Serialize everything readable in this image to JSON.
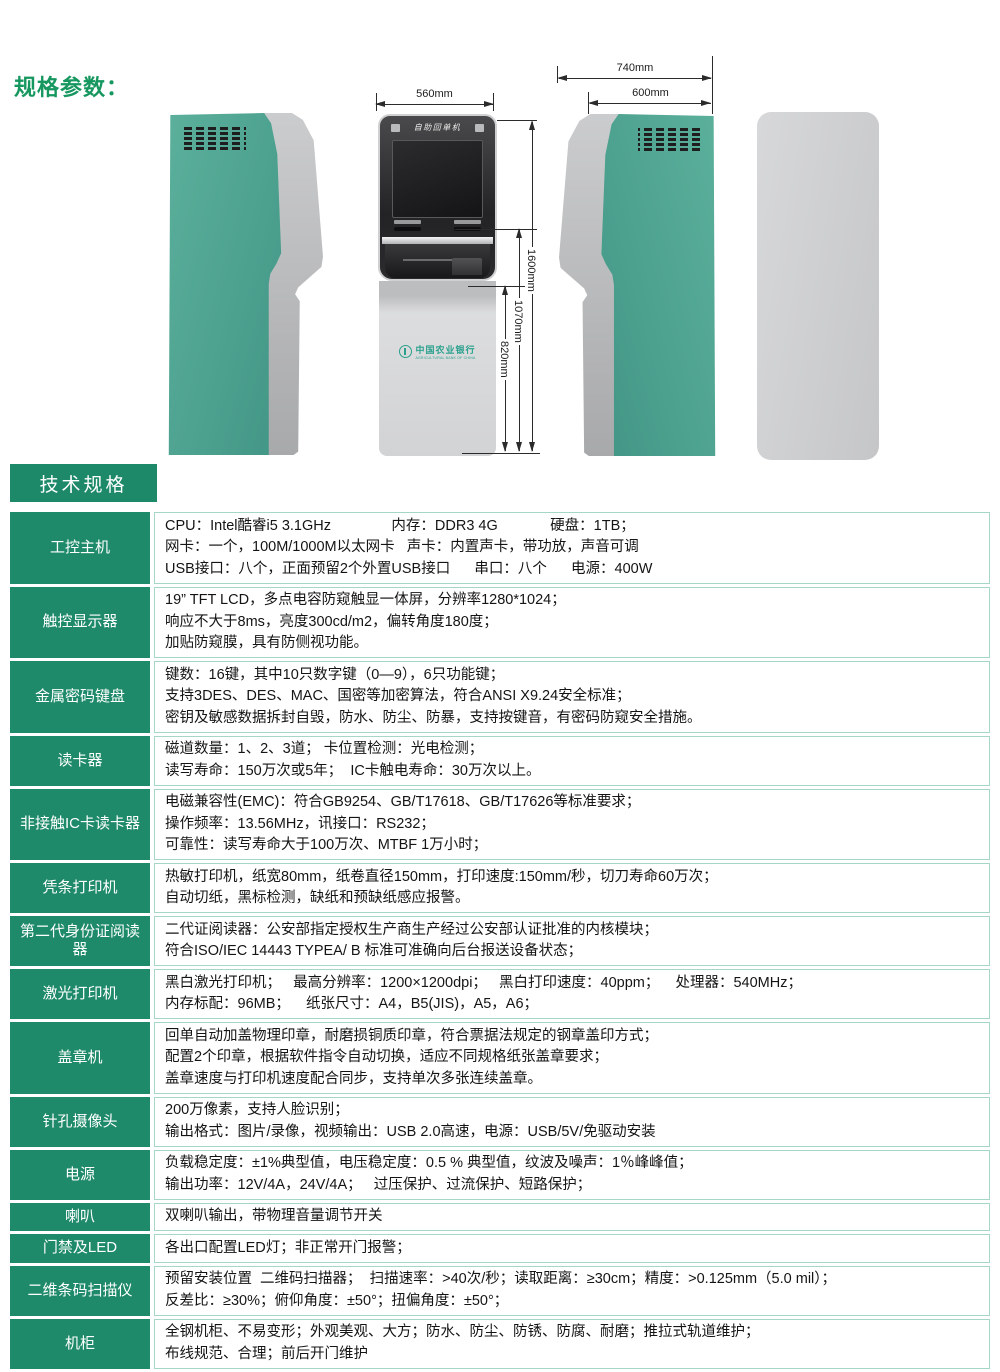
{
  "heading": "规格参数：",
  "section_title": "技术规格",
  "colors": {
    "accent_green": "#1e8a69",
    "heading_green": "#16975f",
    "kiosk_green": "#4aa492",
    "table_border": "#a5d6c6",
    "logo_teal": "#2aa18d"
  },
  "figure": {
    "kiosk_title": "自助回单机",
    "bank_cn": "中国农业银行",
    "bank_en": "AGRICULTURAL BANK OF CHINA",
    "dims": {
      "front_width": "560mm",
      "side_depth_total": "740mm",
      "side_depth_body": "600mm",
      "height_total": "1600mm",
      "height_console": "1070mm",
      "height_cabinet": "820mm"
    }
  },
  "table": {
    "rows": [
      {
        "label": "工控主机",
        "lines": [
          "CPU：Intel酷睿i5 3.1GHz               内存：DDR3 4G             硬盘：1TB；",
          "网卡：一个，100M/1000M以太网卡   声卡：内置声卡，带功放，声音可调",
          "USB接口：八个，正面预留2个外置USB接口      串口：八个      电源：400W"
        ]
      },
      {
        "label": "触控显示器",
        "lines": [
          "19” TFT LCD，多点电容防窥触显一体屏，分辨率1280*1024；",
          "响应不大于8ms，亮度300cd/m2，偏转角度180度；",
          "加贴防窥膜，具有防侧视功能。"
        ]
      },
      {
        "label": "金属密码键盘",
        "lines": [
          "键数：16键，其中10只数字键（0—9），6只功能键；",
          "支持3DES、DES、MAC、国密等加密算法，符合ANSI X9.24安全标准；",
          "密钥及敏感数据拆封自毁，防水、防尘、防暴，支持按键音，有密码防窥安全措施。"
        ]
      },
      {
        "label": "读卡器",
        "lines": [
          "磁道数量：1、2、3道； 卡位置检测：光电检测；",
          "读写寿命：150万次或5年；  IC卡触电寿命：30万次以上。"
        ]
      },
      {
        "label": "非接触IC卡读卡器",
        "lines": [
          "电磁兼容性(EMC)：符合GB9254、GB/T17618、GB/T17626等标准要求；",
          "操作频率：13.56MHz，讯接口：RS232；",
          "可靠性：读写寿命大于100万次、MTBF 1万小时；"
        ]
      },
      {
        "label": "凭条打印机",
        "lines": [
          "热敏打印机，纸宽80mm，纸卷直径150mm，打印速度:150mm/秒，切刀寿命60万次；",
          "自动切纸，黑标检测，缺纸和预缺纸感应报警。"
        ]
      },
      {
        "label": "第二代身份证阅读器",
        "lines": [
          "二代证阅读器：公安部指定授权生产商生产经过公安部认证批准的内核模块；",
          "符合ISO/IEC 14443 TYPEA/ B 标准可准确向后台报送设备状态；"
        ]
      },
      {
        "label": "激光打印机",
        "lines": [
          "黑白激光打印机；   最高分辨率：1200×1200dpi；   黑白打印速度：40ppm；    处理器：540MHz；",
          "内存标配：96MB；    纸张尺寸：A4，B5(JIS)，A5，A6；"
        ]
      },
      {
        "label": "盖章机",
        "lines": [
          "回单自动加盖物理印章，耐磨损铜质印章，符合票据法规定的钢章盖印方式；",
          "配置2个印章，根据软件指令自动切换，适应不同规格纸张盖章要求；",
          "盖章速度与打印机速度配合同步，支持单次多张连续盖章。"
        ]
      },
      {
        "label": "针孔摄像头",
        "lines": [
          "200万像素，支持人脸识别；",
          "输出格式：图片/录像，视频输出：USB 2.0高速，电源：USB/5V/免驱动安装"
        ]
      },
      {
        "label": "电源",
        "lines": [
          "负载稳定度：±1%典型值，电压稳定度：0.5 % 典型值，纹波及噪声：1％峰峰值；",
          "输出功率：12V/4A，24V/4A；   过压保护、过流保护、短路保护；"
        ]
      },
      {
        "label": "喇叭",
        "lines": [
          "双喇叭输出，带物理音量调节开关"
        ]
      },
      {
        "label": "门禁及LED",
        "lines": [
          "各出口配置LED灯；非正常开门报警；"
        ]
      },
      {
        "label": "二维条码扫描仪",
        "lines": [
          "预留安装位置  二维码扫描器；  扫描速率：>40次/秒；读取距离：≥30cm；精度：>0.125mm（5.0 mil）；",
          "反差比：≥30%；俯仰角度：±50°；扭偏角度：±50°；"
        ]
      },
      {
        "label": "机柜",
        "lines": [
          "全钢机柜、不易变形；外观美观、大方；防水、防尘、防锈、防腐、耐磨；推拉式轨道维护；",
          "布线规范、合理；前后开门维护"
        ]
      }
    ]
  }
}
